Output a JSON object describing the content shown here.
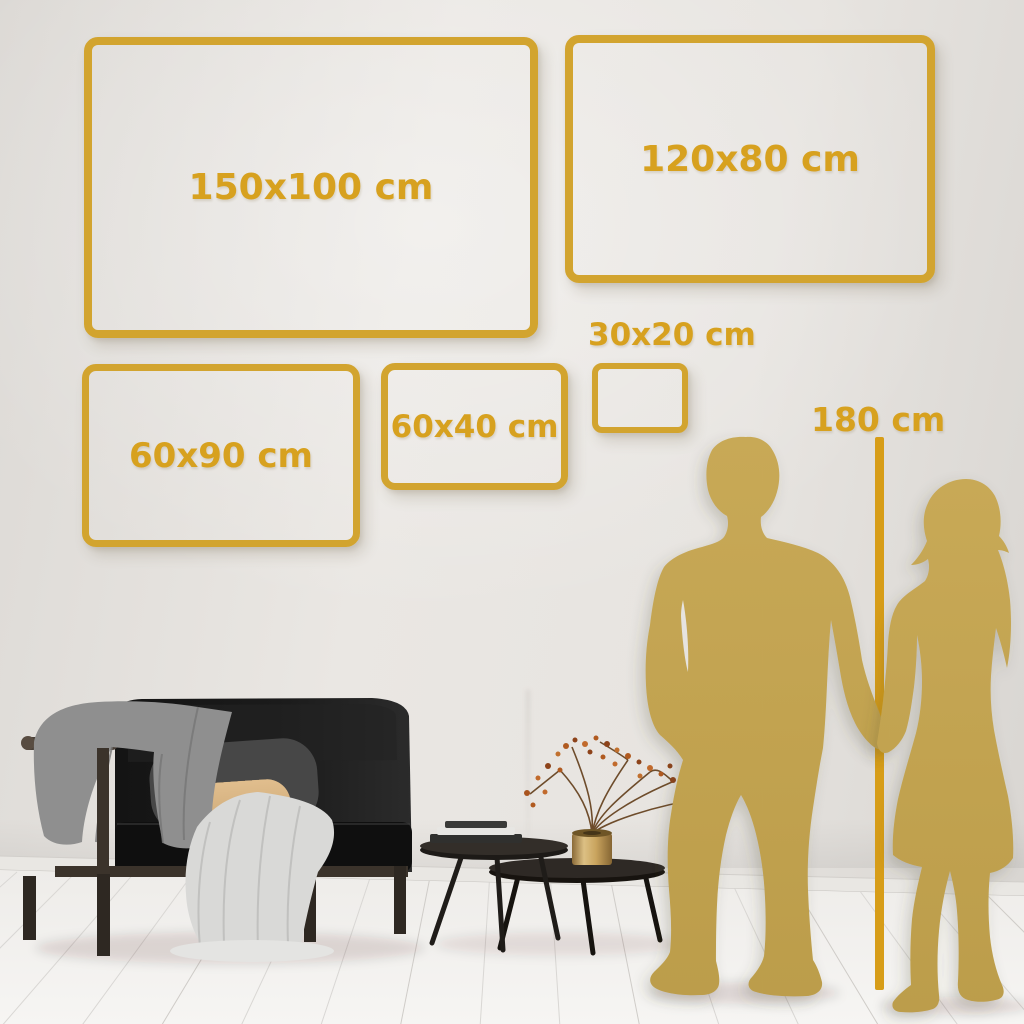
{
  "palette": {
    "gold": "#d2a42f",
    "gold_deep": "#d79d18",
    "text_gold": "#d7a11f",
    "silhouette": "#c3a351",
    "wall": "#e6e3df",
    "floor": "#f2f1ee"
  },
  "size_guide": {
    "boxes": [
      {
        "label": "150x100 cm"
      },
      {
        "label": "120x80 cm"
      },
      {
        "label": "60x90 cm"
      },
      {
        "label": "60x40 cm"
      },
      {
        "label": "30x20 cm"
      }
    ],
    "height_marker": {
      "label": "180 cm"
    }
  },
  "scene": {
    "figures": [
      {
        "name": "man-silhouette"
      },
      {
        "name": "woman-silhouette"
      }
    ],
    "furniture": [
      {
        "name": "sofa-with-blankets"
      },
      {
        "name": "nesting-coffee-tables"
      },
      {
        "name": "brass-vase-with-dried-branch"
      }
    ]
  }
}
